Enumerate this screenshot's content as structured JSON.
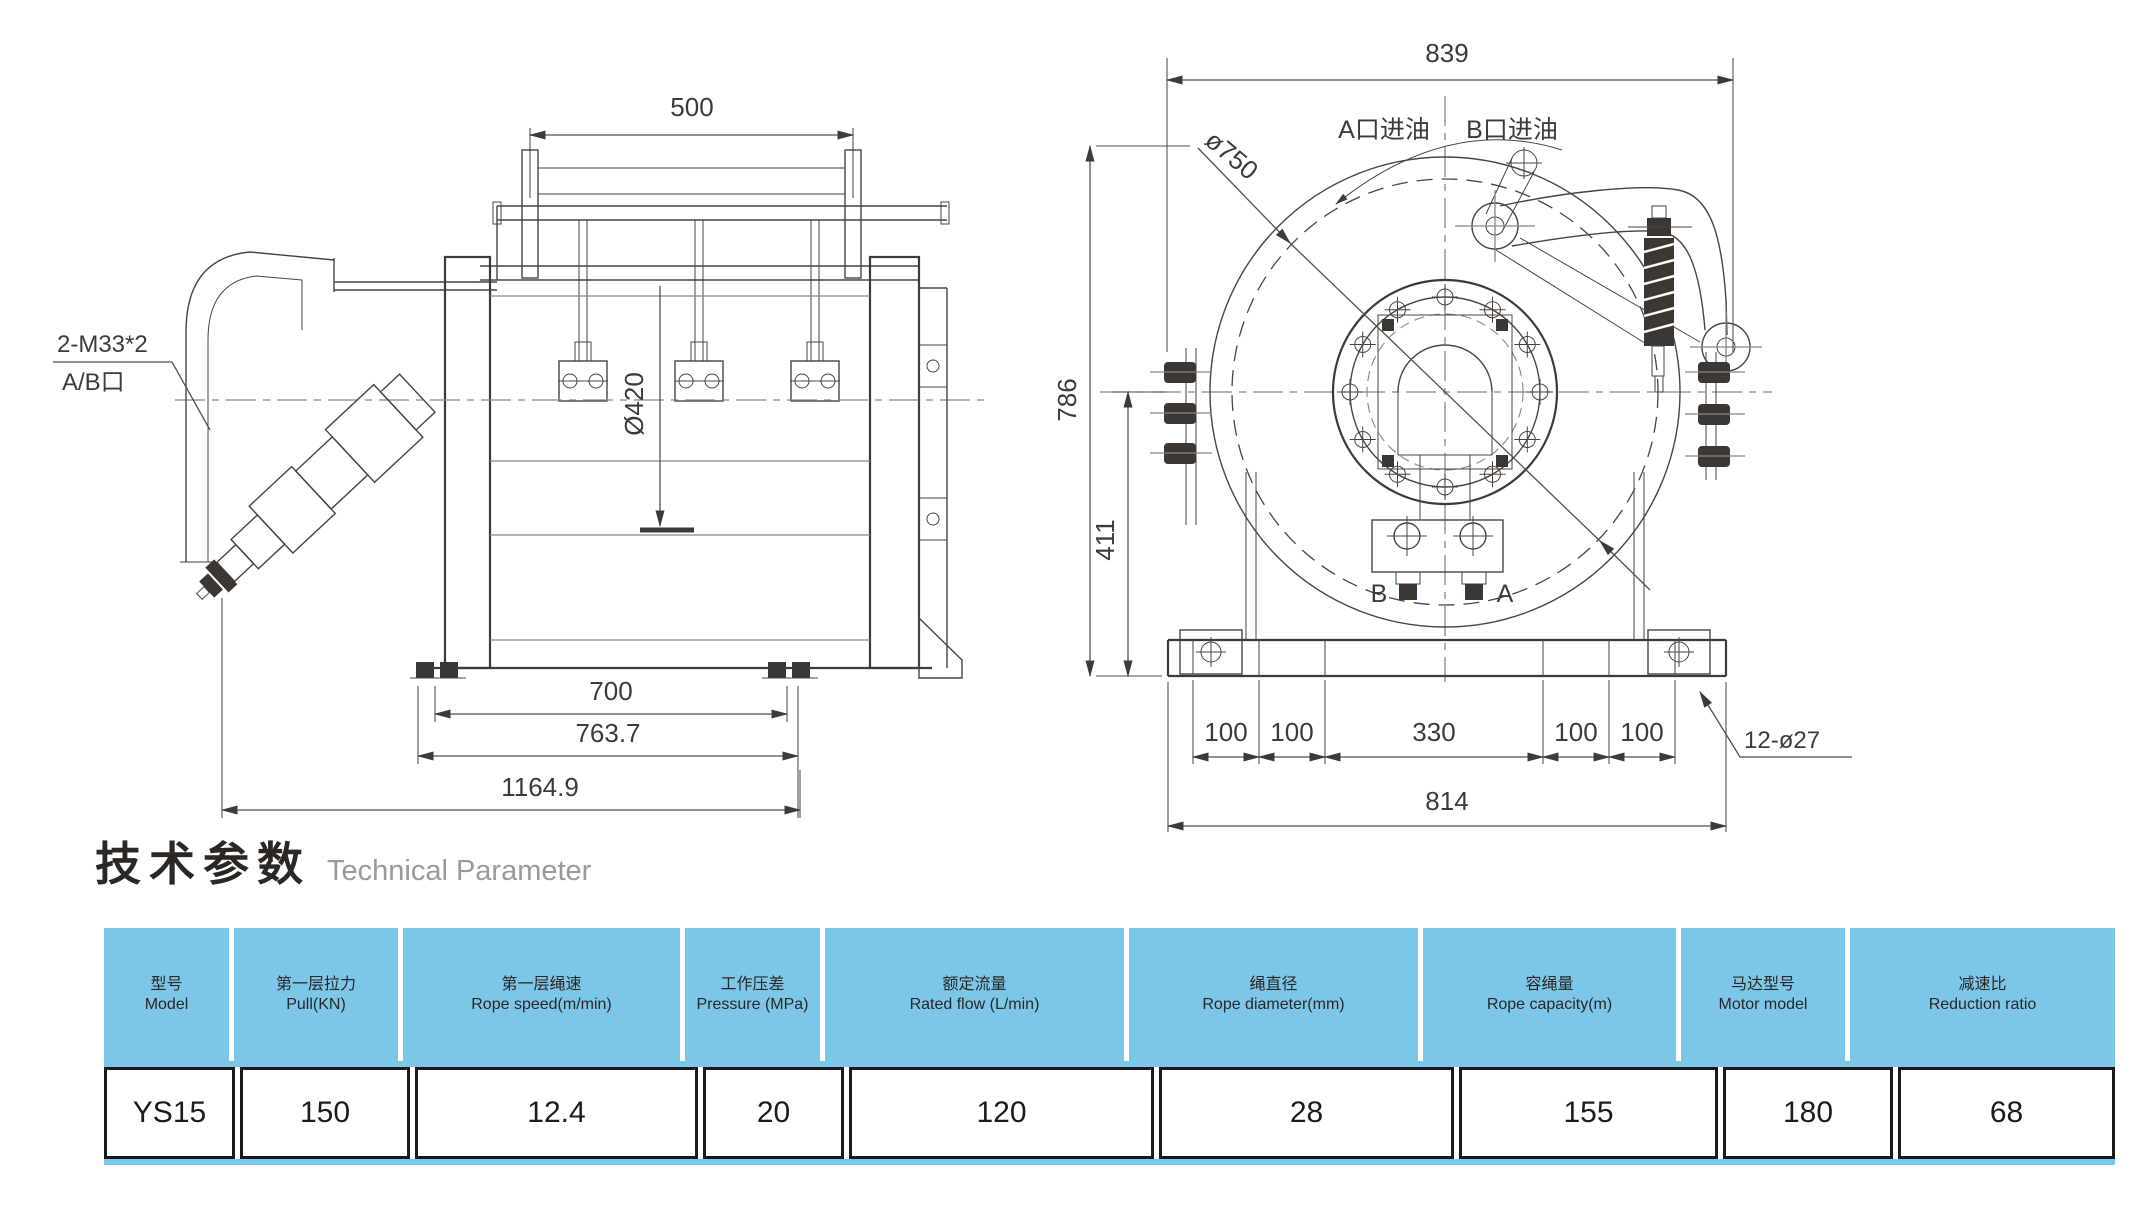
{
  "title": {
    "zh": "技术参数",
    "en": "Technical Parameter"
  },
  "colors": {
    "table_header_bg": "#7cc7e8",
    "drawing_line": "#4a443f",
    "dimension_text": "#3f3a38",
    "title_en_gray": "#9a9a9a"
  },
  "left_view": {
    "dim_top_width": "500",
    "dim_drum_diameter": "Ø420",
    "dim_inner_base": "700",
    "dim_base": "763.7",
    "dim_overall_length": "1164.9",
    "port_label_line1": "2-M33*2",
    "port_label_line2": "A/B口"
  },
  "right_view": {
    "dim_overall_width": "839",
    "dim_flange_diameter": "ø750",
    "dim_overall_height": "786",
    "dim_center_height": "411",
    "dim_hole_spacing": [
      "100",
      "100",
      "330",
      "100",
      "100"
    ],
    "dim_base_width": "814",
    "holes_label": "12-ø27",
    "port_a_label": "A口进油",
    "port_b_label": "B口进油",
    "valve_b": "B",
    "valve_a": "A"
  },
  "table": {
    "columns": [
      {
        "zh": "型号",
        "en": "Model"
      },
      {
        "zh": "第一层拉力",
        "en": "Pull(KN)"
      },
      {
        "zh": "第一层绳速",
        "en": "Rope speed(m/min)"
      },
      {
        "zh": "工作压差",
        "en": "Pressure (MPa)"
      },
      {
        "zh": "额定流量",
        "en": "Rated flow (L/min)"
      },
      {
        "zh": "绳直径",
        "en": "Rope diameter(mm)"
      },
      {
        "zh": "容绳量",
        "en": "Rope capacity(m)"
      },
      {
        "zh": "马达型号",
        "en": "Motor model"
      },
      {
        "zh": "减速比",
        "en": "Reduction ratio"
      }
    ],
    "row": [
      "YS15",
      "150",
      "12.4",
      "20",
      "120",
      "28",
      "155",
      "180",
      "68"
    ]
  }
}
